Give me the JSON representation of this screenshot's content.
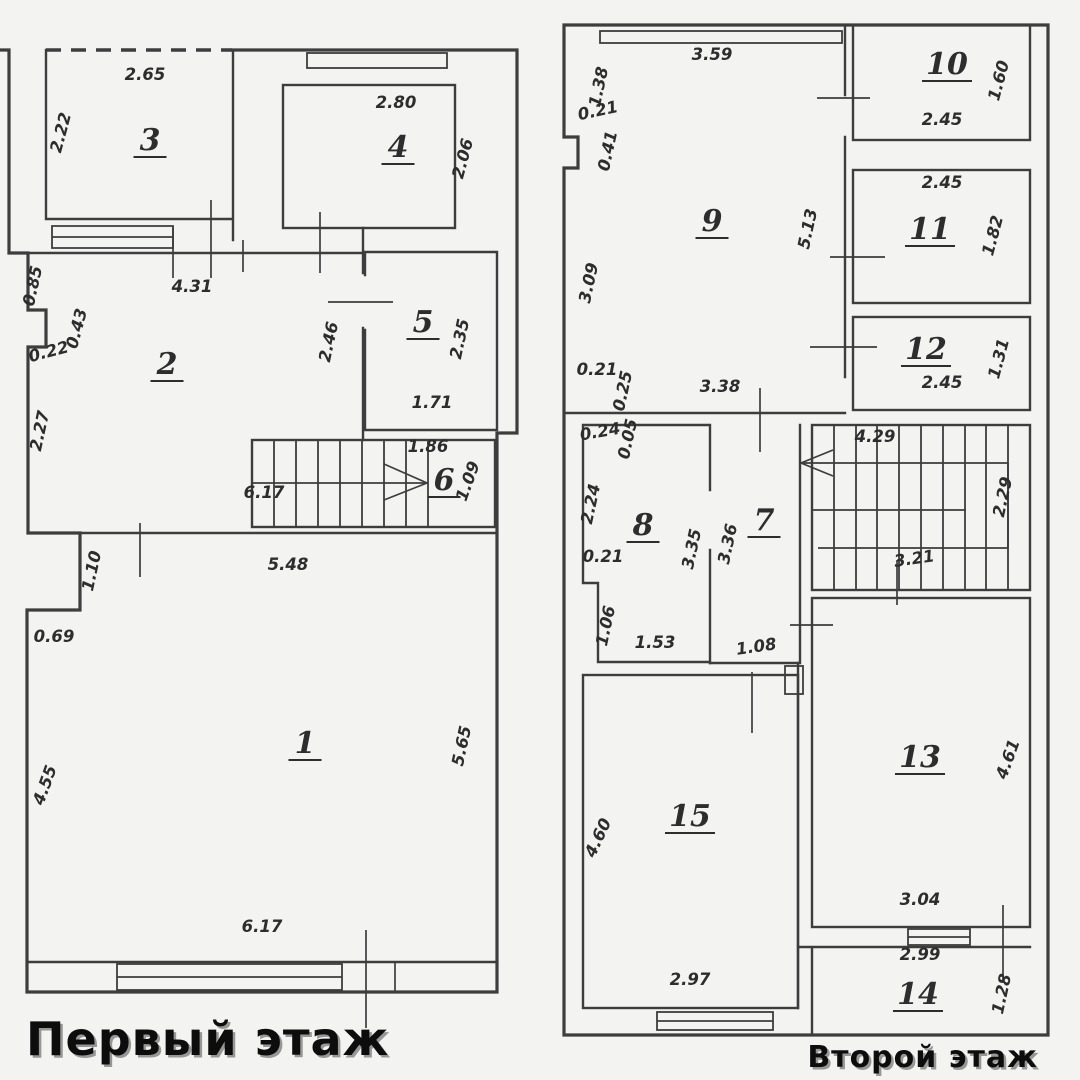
{
  "titles": {
    "floor1": "Первый этаж",
    "floor2": "Второй этаж"
  },
  "colors": {
    "background": "#f3f3f1",
    "line": "#3d3d3d",
    "text": "#2d2d2d",
    "title": "#0d0d0d"
  },
  "floor1": {
    "rooms": [
      {
        "number": "3",
        "x": 150,
        "y": 140
      },
      {
        "number": "4",
        "x": 398,
        "y": 147
      },
      {
        "number": "2",
        "x": 167,
        "y": 364
      },
      {
        "number": "5",
        "x": 423,
        "y": 322
      },
      {
        "number": "6",
        "x": 444,
        "y": 480
      },
      {
        "number": "1",
        "x": 305,
        "y": 743
      }
    ],
    "dims": [
      {
        "text": "2.65",
        "x": 145,
        "y": 80,
        "angle": 0
      },
      {
        "text": "2.22",
        "x": 66,
        "y": 134,
        "angle": -75
      },
      {
        "text": "2.80",
        "x": 396,
        "y": 108,
        "angle": 0
      },
      {
        "text": "2.06",
        "x": 468,
        "y": 160,
        "angle": -75
      },
      {
        "text": "4.31",
        "x": 192,
        "y": 292,
        "angle": 0
      },
      {
        "text": "0.85",
        "x": 38,
        "y": 287,
        "angle": -78
      },
      {
        "text": "0.43",
        "x": 82,
        "y": 330,
        "angle": -75
      },
      {
        "text": "0.22",
        "x": 50,
        "y": 357,
        "angle": -15
      },
      {
        "text": "2.27",
        "x": 45,
        "y": 432,
        "angle": -78
      },
      {
        "text": "2.46",
        "x": 334,
        "y": 343,
        "angle": -78
      },
      {
        "text": "2.35",
        "x": 465,
        "y": 340,
        "angle": -78
      },
      {
        "text": "1.71",
        "x": 432,
        "y": 408,
        "angle": 0
      },
      {
        "text": "1.86",
        "x": 428,
        "y": 452,
        "angle": 0
      },
      {
        "text": "1.09",
        "x": 473,
        "y": 483,
        "angle": -70
      },
      {
        "text": "6.17",
        "x": 264,
        "y": 498,
        "angle": 0
      },
      {
        "text": "1.10",
        "x": 97,
        "y": 572,
        "angle": -78
      },
      {
        "text": "5.48",
        "x": 288,
        "y": 570,
        "angle": 0
      },
      {
        "text": "0.69",
        "x": 54,
        "y": 642,
        "angle": 0
      },
      {
        "text": "4.55",
        "x": 50,
        "y": 787,
        "angle": -70
      },
      {
        "text": "5.65",
        "x": 467,
        "y": 747,
        "angle": -78
      },
      {
        "text": "6.17",
        "x": 262,
        "y": 932,
        "angle": 0
      }
    ]
  },
  "floor2": {
    "rooms": [
      {
        "number": "9",
        "x": 712,
        "y": 221
      },
      {
        "number": "10",
        "x": 947,
        "y": 64
      },
      {
        "number": "11",
        "x": 930,
        "y": 229
      },
      {
        "number": "12",
        "x": 926,
        "y": 349
      },
      {
        "number": "8",
        "x": 643,
        "y": 525
      },
      {
        "number": "7",
        "x": 764,
        "y": 520
      },
      {
        "number": "13",
        "x": 920,
        "y": 757
      },
      {
        "number": "15",
        "x": 690,
        "y": 816
      },
      {
        "number": "14",
        "x": 918,
        "y": 994
      }
    ],
    "dims": [
      {
        "text": "3.59",
        "x": 712,
        "y": 60,
        "angle": 0
      },
      {
        "text": "1.38",
        "x": 604,
        "y": 88,
        "angle": -78
      },
      {
        "text": "0.21",
        "x": 599,
        "y": 116,
        "angle": -12
      },
      {
        "text": "0.41",
        "x": 613,
        "y": 152,
        "angle": -78
      },
      {
        "text": "3.09",
        "x": 594,
        "y": 284,
        "angle": -78
      },
      {
        "text": "5.13",
        "x": 813,
        "y": 230,
        "angle": -78
      },
      {
        "text": "1.60",
        "x": 1004,
        "y": 82,
        "angle": -75
      },
      {
        "text": "2.45",
        "x": 942,
        "y": 125,
        "angle": 0
      },
      {
        "text": "2.45",
        "x": 942,
        "y": 188,
        "angle": 0
      },
      {
        "text": "1.82",
        "x": 998,
        "y": 237,
        "angle": -75
      },
      {
        "text": "1.31",
        "x": 1004,
        "y": 360,
        "angle": -75
      },
      {
        "text": "2.45",
        "x": 942,
        "y": 388,
        "angle": 0
      },
      {
        "text": "0.21",
        "x": 597,
        "y": 375,
        "angle": 0
      },
      {
        "text": "0.25",
        "x": 628,
        "y": 392,
        "angle": -78
      },
      {
        "text": "3.38",
        "x": 720,
        "y": 392,
        "angle": 0
      },
      {
        "text": "0.24",
        "x": 601,
        "y": 437,
        "angle": -10
      },
      {
        "text": "0.05",
        "x": 633,
        "y": 440,
        "angle": -78
      },
      {
        "text": "2.24",
        "x": 596,
        "y": 505,
        "angle": -78
      },
      {
        "text": "3.35",
        "x": 697,
        "y": 550,
        "angle": -78
      },
      {
        "text": "3.36",
        "x": 733,
        "y": 545,
        "angle": -78
      },
      {
        "text": "0.21",
        "x": 603,
        "y": 562,
        "angle": 0
      },
      {
        "text": "1.06",
        "x": 611,
        "y": 627,
        "angle": -78
      },
      {
        "text": "1.53",
        "x": 655,
        "y": 648,
        "angle": 0
      },
      {
        "text": "1.08",
        "x": 757,
        "y": 652,
        "angle": -8
      },
      {
        "text": "4.29",
        "x": 875,
        "y": 442,
        "angle": 0
      },
      {
        "text": "2.29",
        "x": 1008,
        "y": 498,
        "angle": -78
      },
      {
        "text": "3.21",
        "x": 915,
        "y": 564,
        "angle": -8
      },
      {
        "text": "4.61",
        "x": 1013,
        "y": 761,
        "angle": -70
      },
      {
        "text": "3.04",
        "x": 920,
        "y": 905,
        "angle": 0
      },
      {
        "text": "4.60",
        "x": 603,
        "y": 840,
        "angle": -65
      },
      {
        "text": "2.97",
        "x": 690,
        "y": 985,
        "angle": 0
      },
      {
        "text": "2.99",
        "x": 920,
        "y": 960,
        "angle": 0
      },
      {
        "text": "1.28",
        "x": 1007,
        "y": 995,
        "angle": -78
      }
    ]
  }
}
